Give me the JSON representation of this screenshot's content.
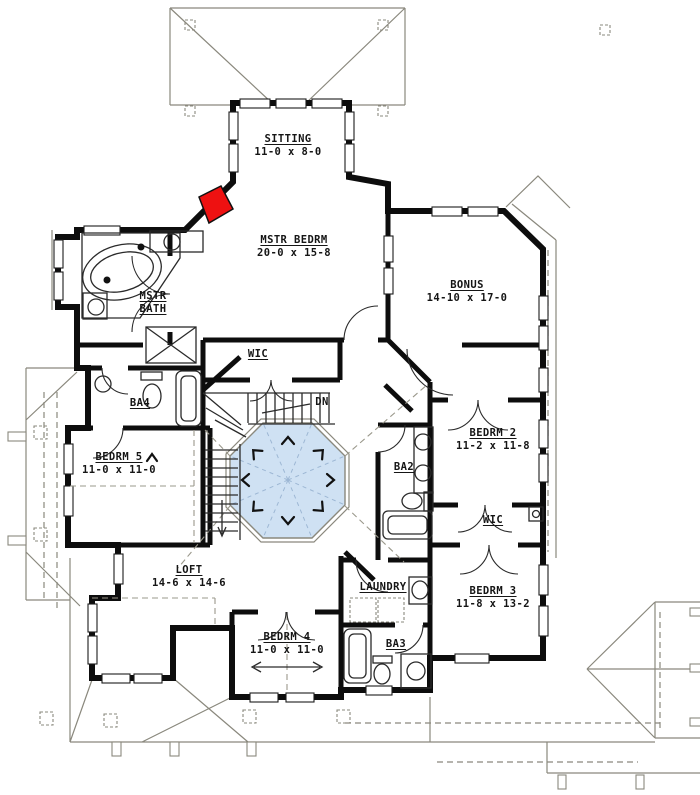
{
  "colors": {
    "room_fill": "#f8f2cc",
    "open_to_below_fill": "#cfe1f3",
    "wall": "#0d0d0d",
    "roof_line": "#8a887d",
    "fireplace_red": "#ee1111"
  },
  "rooms": {
    "sitting": {
      "name": "SITTING",
      "dims": "11-0 x 8-0"
    },
    "mstr_bedrm": {
      "name": "MSTR BEDRM",
      "dims": "20-0 x 15-8"
    },
    "bonus": {
      "name": "BONUS",
      "dims": "14-10 x 17-0"
    },
    "mstr_bath": {
      "name": "MSTR",
      "name2": "BATH"
    },
    "wic_master": {
      "name": "WIC"
    },
    "ba4": {
      "name": "BA4"
    },
    "bedrm5": {
      "name": "BEDRM 5",
      "dims": "11-0 x 11-0"
    },
    "bedrm2": {
      "name": "BEDRM 2",
      "dims": "11-2 x 11-8"
    },
    "ba2": {
      "name": "BA2"
    },
    "wic2": {
      "name": "WIC"
    },
    "loft": {
      "name": "LOFT",
      "dims": "14-6 x 14-6"
    },
    "laundry": {
      "name": "LAUNDRY"
    },
    "bedrm3": {
      "name": "BEDRM 3",
      "dims": "11-8 x 13-2"
    },
    "bedrm4": {
      "name": "BEDRM 4",
      "dims": "11-0 x 11-0"
    },
    "ba3": {
      "name": "BA3"
    },
    "stairs": {
      "down_label": "DN"
    }
  }
}
